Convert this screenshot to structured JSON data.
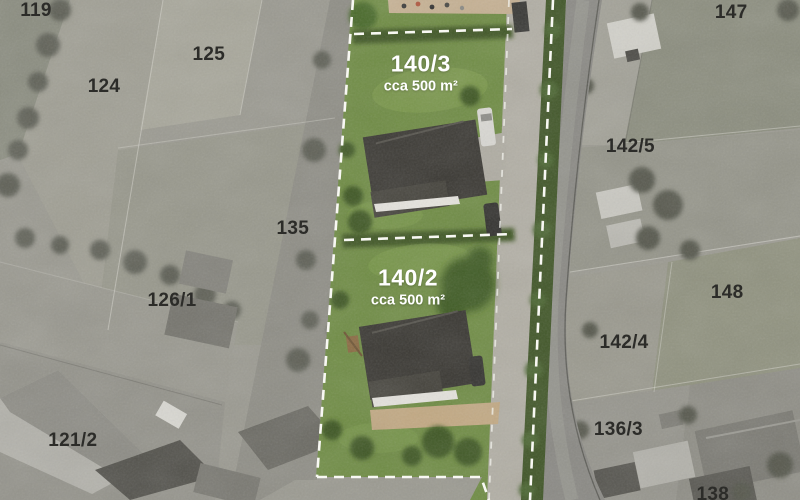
{
  "map": {
    "parcel_labels": [
      {
        "label": "119",
        "x": 4.5,
        "y": 2.2
      },
      {
        "label": "124",
        "x": 13.0,
        "y": 17.3
      },
      {
        "label": "125",
        "x": 26.1,
        "y": 10.9
      },
      {
        "label": "135",
        "x": 36.6,
        "y": 45.8
      },
      {
        "label": "126/1",
        "x": 21.5,
        "y": 60.2
      },
      {
        "label": "121/2",
        "x": 9.1,
        "y": 88.2
      },
      {
        "label": "147",
        "x": 91.4,
        "y": 2.6
      },
      {
        "label": "142/5",
        "x": 78.8,
        "y": 29.4
      },
      {
        "label": "148",
        "x": 90.9,
        "y": 58.5
      },
      {
        "label": "142/4",
        "x": 78.0,
        "y": 68.5
      },
      {
        "label": "136/3",
        "x": 77.3,
        "y": 86.0
      },
      {
        "label": "138",
        "x": 89.1,
        "y": 99.0
      }
    ],
    "plots": [
      {
        "label": "140/3",
        "area": "cca 500 m²",
        "x": 52.6,
        "y": 14.6
      },
      {
        "label": "140/2",
        "area": "cca 500 m²",
        "x": 51.0,
        "y": 57.4
      }
    ],
    "colors": {
      "highlight_grass": "#6f8c44",
      "hedge_green": "#3f5526",
      "boundary_dash": "#f8f8f3",
      "parcel_label_text": "#2c2c29",
      "plot_label_text": "#ffffff",
      "road_gray": "#8a8984"
    }
  }
}
